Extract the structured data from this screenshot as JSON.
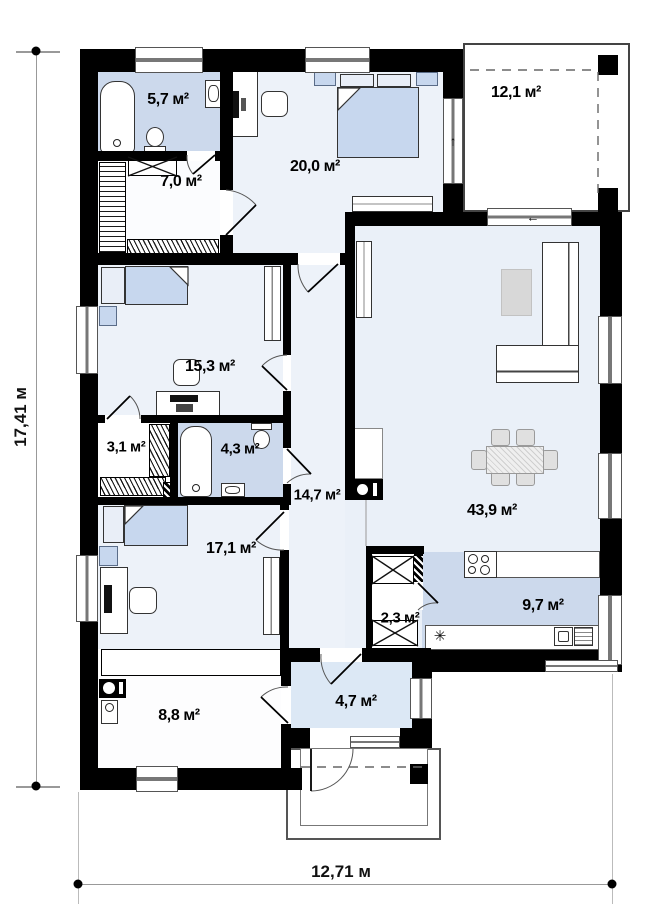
{
  "plan_type": "single-storey house floor plan",
  "dimensions": {
    "width": "12,71 м",
    "height": "17,41 м"
  },
  "rooms": [
    {
      "id": "bathroom-1",
      "label": "5,7 м²"
    },
    {
      "id": "closet-1",
      "label": "7,0 м²"
    },
    {
      "id": "bedroom-1",
      "label": "20,0 м²"
    },
    {
      "id": "terrace",
      "label": "12,1 м²"
    },
    {
      "id": "bedroom-2",
      "label": "15,3 м²"
    },
    {
      "id": "closet-2",
      "label": "3,1 м²"
    },
    {
      "id": "bathroom-2",
      "label": "4,3 м²"
    },
    {
      "id": "hallway",
      "label": "14,7 м²"
    },
    {
      "id": "living-room",
      "label": "43,9 м²"
    },
    {
      "id": "shaft-closet",
      "label": "2,3 м²"
    },
    {
      "id": "kitchen",
      "label": "9,7 м²"
    },
    {
      "id": "bedroom-3",
      "label": "17,1 м²"
    },
    {
      "id": "utility-room",
      "label": "8,8 м²"
    },
    {
      "id": "entrance-hall",
      "label": "4,7 м²"
    }
  ],
  "icons": {
    "up_arrow": "↑",
    "left_arrow": "←",
    "asterisk": "✳"
  },
  "colors": {
    "wall": "#000000",
    "floor": "#edf2f9",
    "wet_room": "#ccd9ec",
    "entry": "#dce8f5",
    "furniture_blue": "#c7d7ee",
    "dimension_line": "#999999"
  }
}
